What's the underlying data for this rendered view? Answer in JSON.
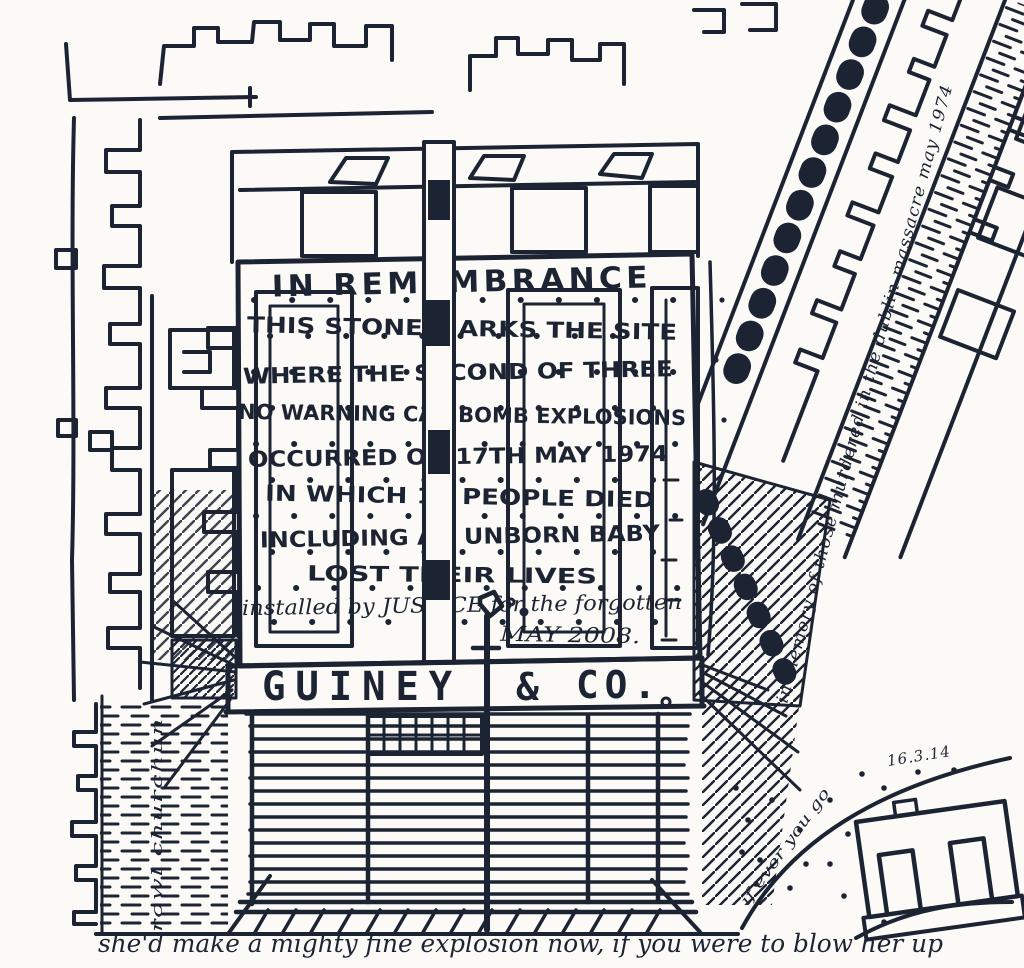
{
  "colors": {
    "ink": "#1c2433",
    "paper": "#fbfaf6"
  },
  "memorial_stone": {
    "inscription": [
      "IN REMEMBRANCE",
      "THIS STONE MARKS THE SITE",
      "WHERE THE SECOND OF THREE",
      "NO WARNING CAR BOMB EXPLOSIONS",
      "OCCURRED ON 17TH MAY 1974",
      "IN WHICH 14 PEOPLE DIED",
      "INCLUDING AN UNBORN BABY",
      "LOST THEIR LIVES",
      "installed by JUSTICE for the forgotten",
      "MAY 2008."
    ]
  },
  "shopfront": {
    "sign_name": "GUINEY",
    "sign_amp": "&",
    "sign_co": "CO."
  },
  "annotations": {
    "street_memorial_note": "in memory of those murdered in the dublin massacre may 1974",
    "left_street_note": "rowl churchun",
    "road_note": "if ever you go",
    "date": "16.3.14",
    "caption": "she'd make a mighty fine explosion now, if you were to blow her up"
  }
}
